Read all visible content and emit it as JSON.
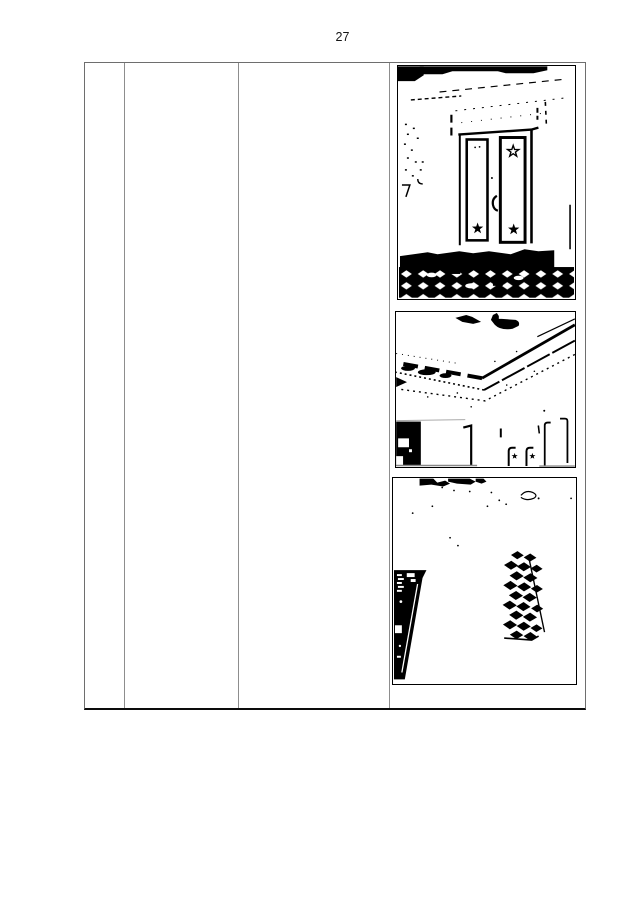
{
  "page": {
    "number": "27",
    "background_color": "#ffffff",
    "ink_color": "#000000"
  },
  "table": {
    "border_color": "#6e6e6e",
    "grid_color": "#8d8d8d",
    "bottom_border_color": "#0c0c0c",
    "rows": 1,
    "columns": 4,
    "cells": [
      {
        "id": "col-1",
        "content": ""
      },
      {
        "id": "col-2",
        "content": ""
      },
      {
        "id": "col-3",
        "content": ""
      },
      {
        "id": "col-4",
        "content": "photo column"
      }
    ],
    "photos": [
      {
        "name": "star-doors-photo",
        "label": "B&W scan: double doors with star motifs, dashed lintel, checkered floor"
      },
      {
        "name": "ceiling-cornice-photo",
        "label": "B&W scan: ceiling cornice V-lines, fan mount, door frames below"
      },
      {
        "name": "floor-runner-photo",
        "label": "B&W scan: diamond-pattern floor runner beside dark wall wedge"
      }
    ]
  }
}
